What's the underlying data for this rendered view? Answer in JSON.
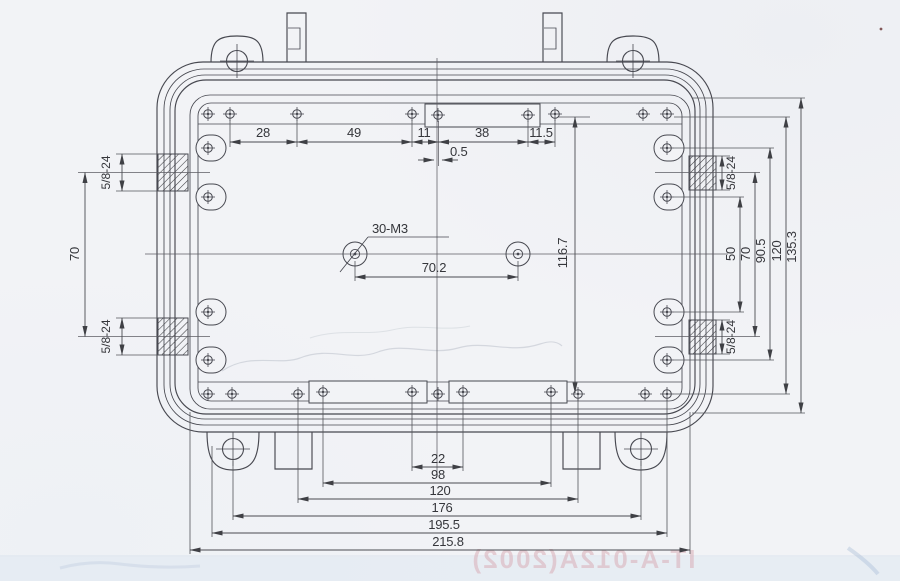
{
  "drawing": {
    "labels": {
      "top_spacings": [
        "28",
        "49",
        "11",
        "38",
        "11.5"
      ],
      "center_offset": "0.5",
      "hole_callout": "30-M3",
      "hole_spacing": "70.2",
      "inner_height": "116.7",
      "right_heights": [
        "50",
        "70",
        "90.5",
        "120",
        "135.3"
      ],
      "left_port_spacing": "70",
      "thread_spec": "5/8-24",
      "bottom_widths": [
        "22",
        "98",
        "120",
        "176",
        "195.5",
        "215.8"
      ],
      "watermark": "IT-A-012A(2002)"
    },
    "colors": {
      "paper": "#f2f3f6",
      "line": "#474850",
      "dim": "#53545a",
      "hatch": "#3c3d41",
      "watermark_pink": "#d8a8b2"
    }
  }
}
